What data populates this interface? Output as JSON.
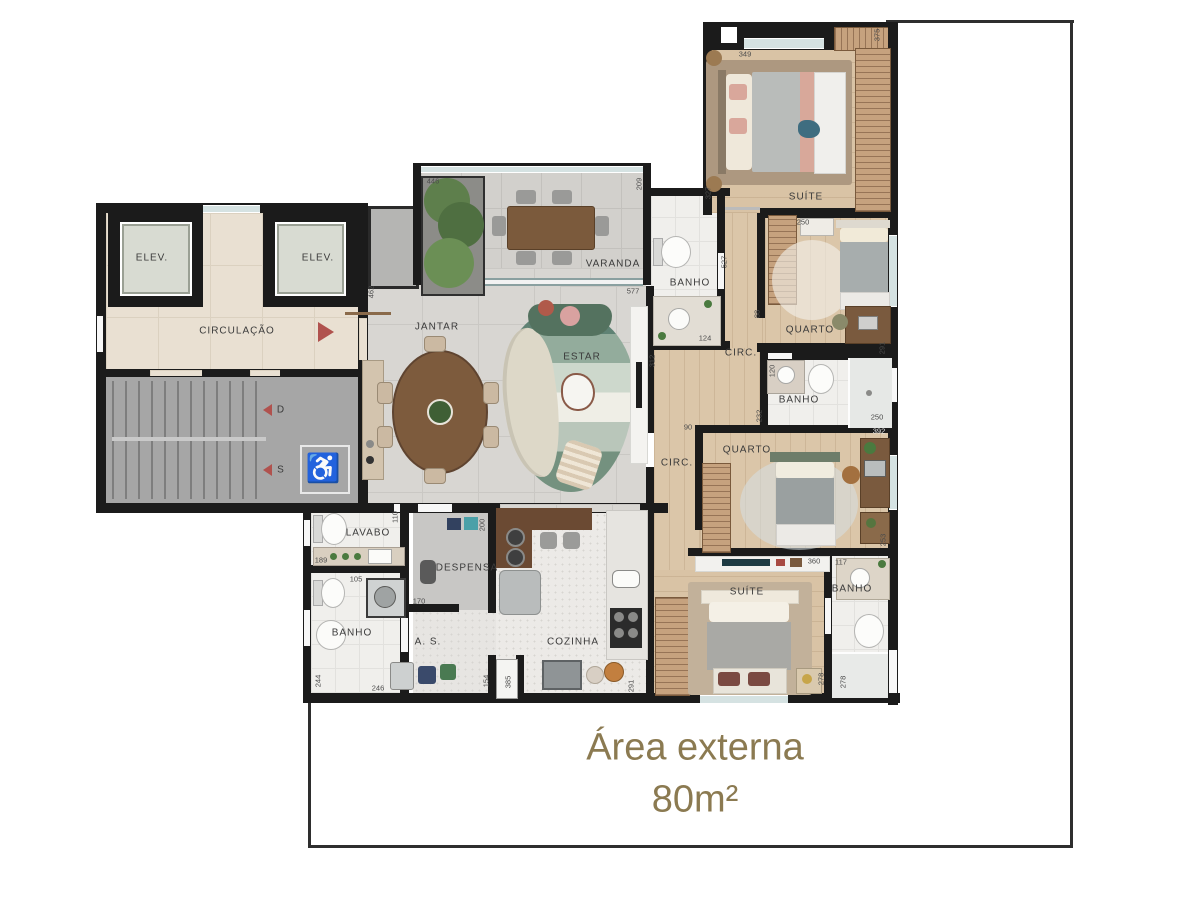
{
  "title": {
    "line1": "Área externa",
    "line2": "80m²"
  },
  "rooms": {
    "elev1": "ELEV.",
    "elev2": "ELEV.",
    "circulacao": "CIRCULAÇÃO",
    "varanda": "VARANDA",
    "jantar": "JANTAR",
    "estar": "ESTAR",
    "banho_top": "BANHO",
    "suite_top": "SUÍTE",
    "quarto1": "QUARTO",
    "circ1": "CIRC.",
    "banho_mid": "BANHO",
    "quarto2": "QUARTO",
    "circ2": "CIRC.",
    "suite_bottom": "SUÍTE",
    "banho_suite": "BANHO",
    "lavabo": "LAVABO",
    "banho_left": "BANHO",
    "despensa": "DESPENSA",
    "area_servico": "A. S.",
    "cozinha": "COZINHA"
  },
  "stairs": {
    "down": "D",
    "up": "S"
  },
  "accessibility_symbol": "♿",
  "dims": {
    "d446": "446",
    "d209": "209",
    "d577": "577",
    "d462": "462",
    "d349": "349",
    "d375": "375",
    "d327": "327",
    "d527": "527",
    "d250a": "250",
    "d291a": "291",
    "d124": "124",
    "d312": "312",
    "d232": "232",
    "d250b": "250",
    "d120": "120",
    "d90": "90",
    "d88": "88",
    "d392": "392",
    "d253": "253",
    "d360": "360",
    "d117": "117",
    "d278a": "278",
    "d278b": "278",
    "d110": "110",
    "d189": "189",
    "d105": "105",
    "d244": "244",
    "d200": "200",
    "d170": "170",
    "d246": "246",
    "d154": "154",
    "d385": "385",
    "d291b": "291"
  },
  "colors": {
    "accent_gold": "#8b7a51",
    "wall": "#1b1b1b",
    "red_marker": "#b0524e"
  }
}
